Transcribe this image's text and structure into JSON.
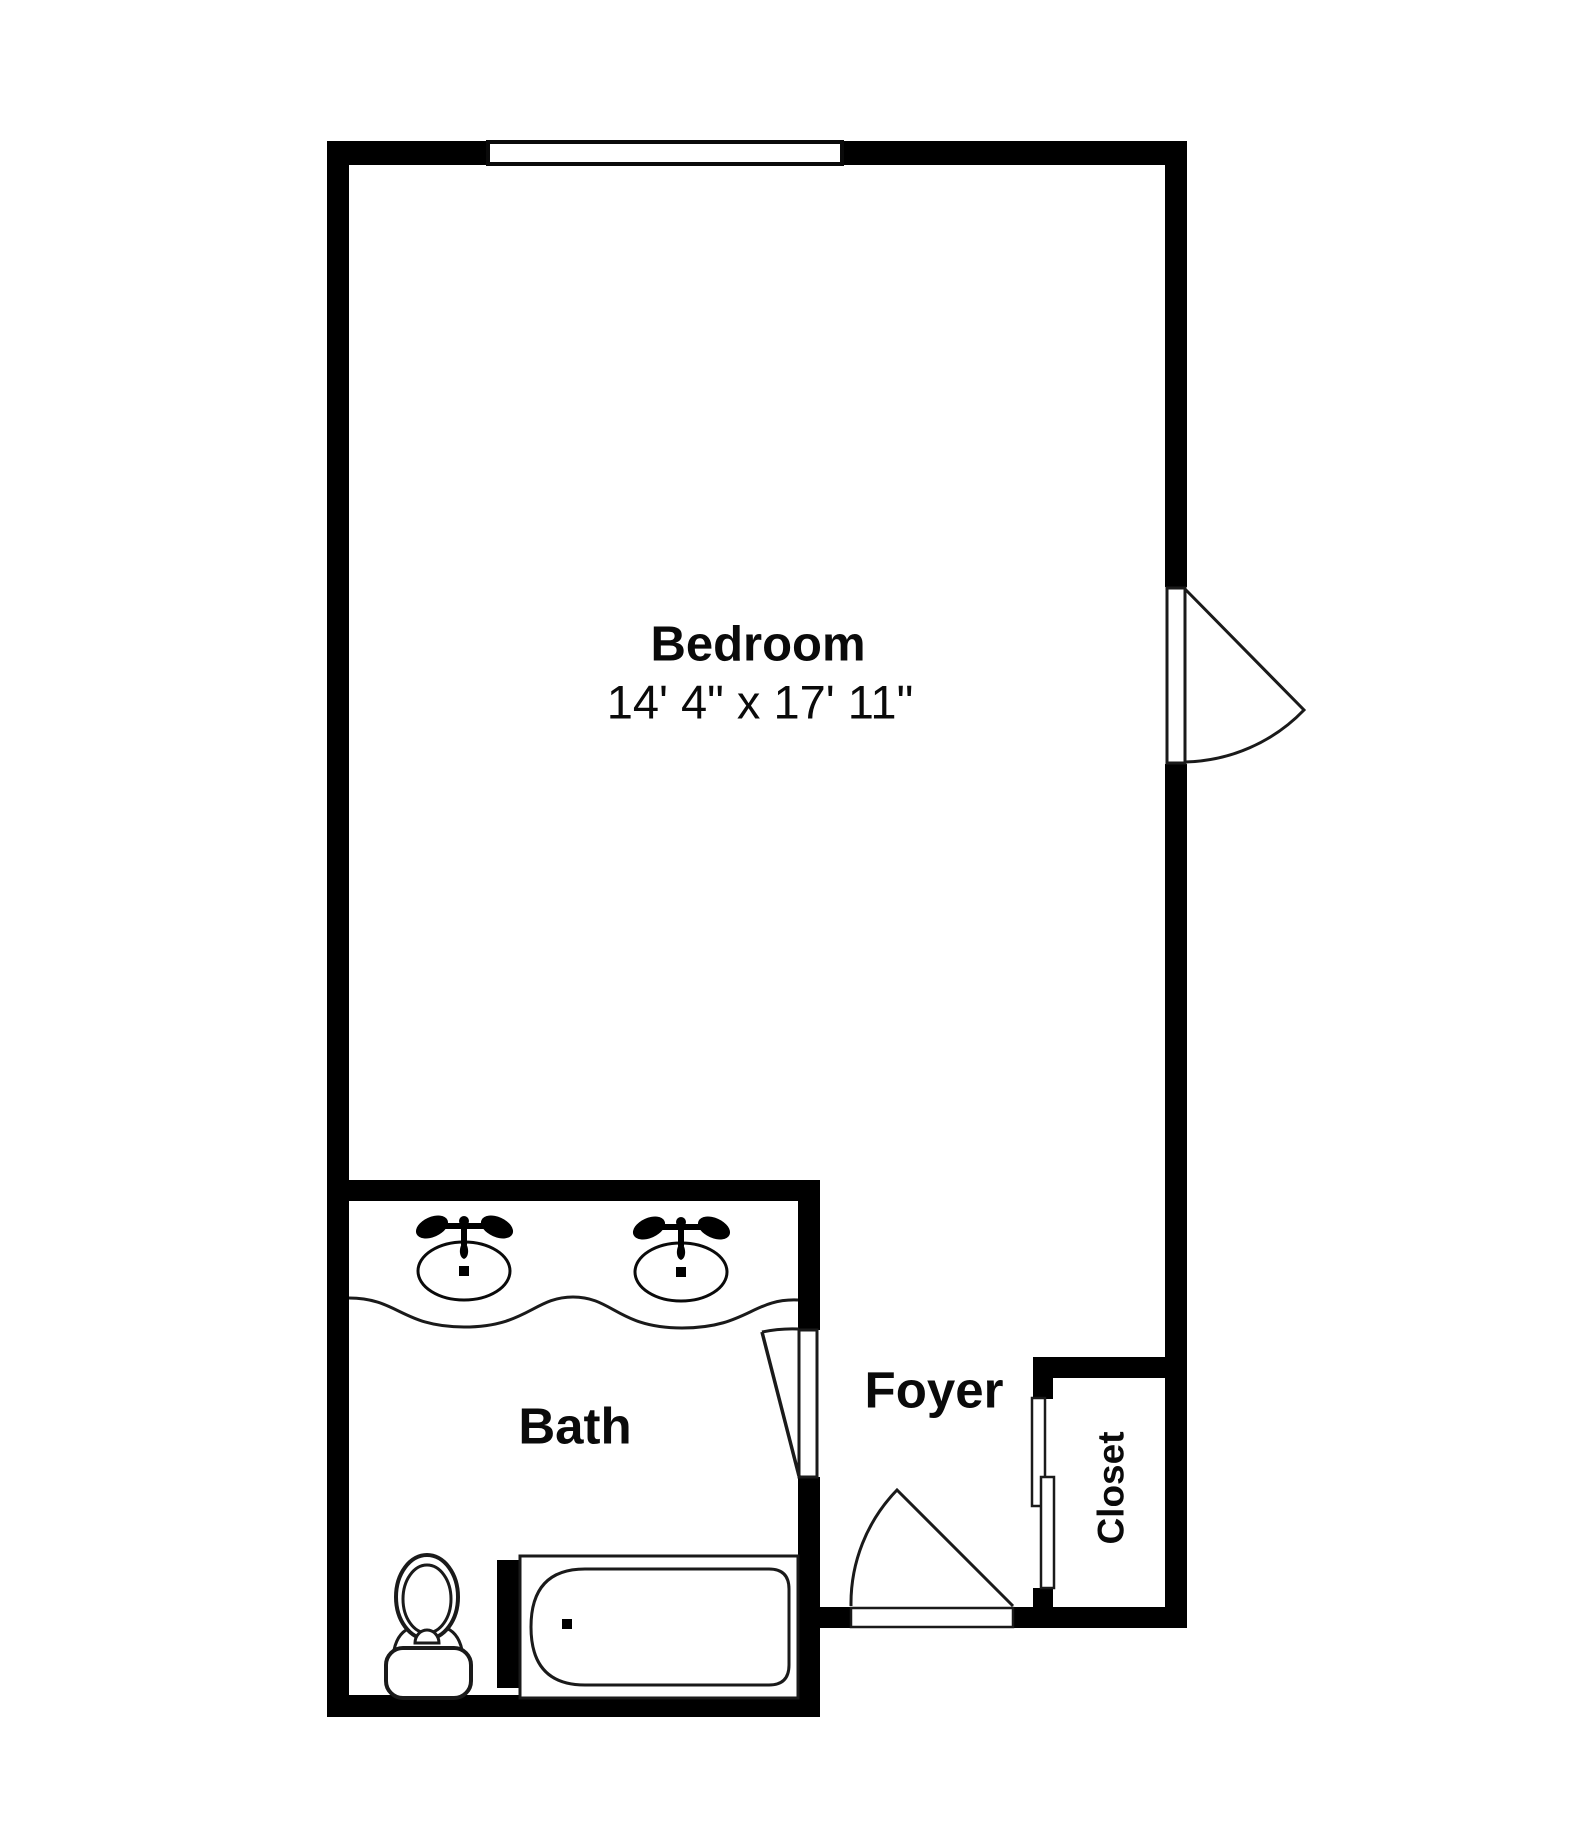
{
  "plan": {
    "background_color": "#ffffff",
    "wall_color": "#000000",
    "line_color": "#1a1a1a",
    "rooms": {
      "bedroom": {
        "label": "Bedroom",
        "dimensions": "14' 4\" x 17' 11\""
      },
      "bath": {
        "label": "Bath"
      },
      "foyer": {
        "label": "Foyer"
      },
      "closet": {
        "label": "Closet"
      }
    },
    "fixtures": [
      "window-icon",
      "bedroom-door-swing-icon",
      "bath-door-swing-icon",
      "entry-door-swing-icon",
      "closet-sliding-door-icon",
      "vanity-sink-icon",
      "vanity-sink-icon",
      "toilet-icon",
      "bathtub-icon"
    ]
  }
}
